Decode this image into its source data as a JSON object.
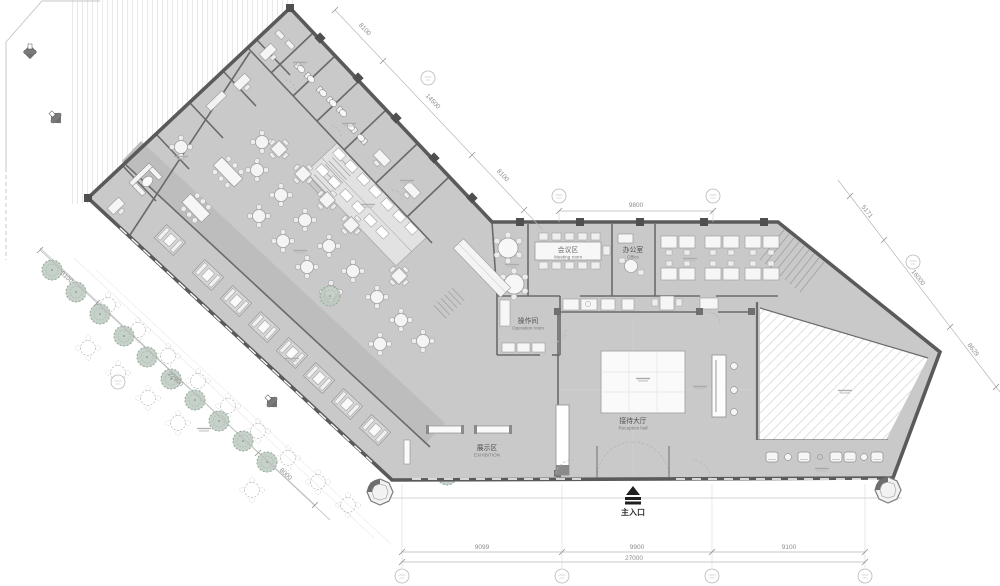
{
  "drawing": {
    "labels": {
      "main_entrance": "主入口",
      "exhibition": {
        "cn": "展示区",
        "en": "EXHIBITION"
      },
      "reception": {
        "cn": "接待大厅",
        "en": "Reception hall"
      },
      "operation": {
        "cn": "操作间",
        "en": "Operation room"
      },
      "meeting": {
        "cn": "会议区",
        "en": "Meeting room"
      },
      "office": {
        "cn": "办公室",
        "en": "Office"
      }
    },
    "dimensions": {
      "top_center": "9800",
      "northeast_edge": [
        "8100",
        "14500",
        "8100"
      ],
      "right_edge": [
        "5171",
        "16000",
        "8629"
      ],
      "bottom_edge": [
        "9099",
        "9900",
        "9100"
      ],
      "bottom_total": "27000",
      "southwest_edge": [
        "8100",
        "22900",
        "8000"
      ]
    },
    "colors": {
      "room_fill": "#c9c9c9",
      "corridor_fill": "#bdbdbd",
      "wall": "#5a5a5a",
      "kitchen_fill": "#e2e2e2",
      "tree": "#b9c9bd",
      "dim_text": "#8c8c8c",
      "furniture": "#f5f5f5"
    }
  }
}
